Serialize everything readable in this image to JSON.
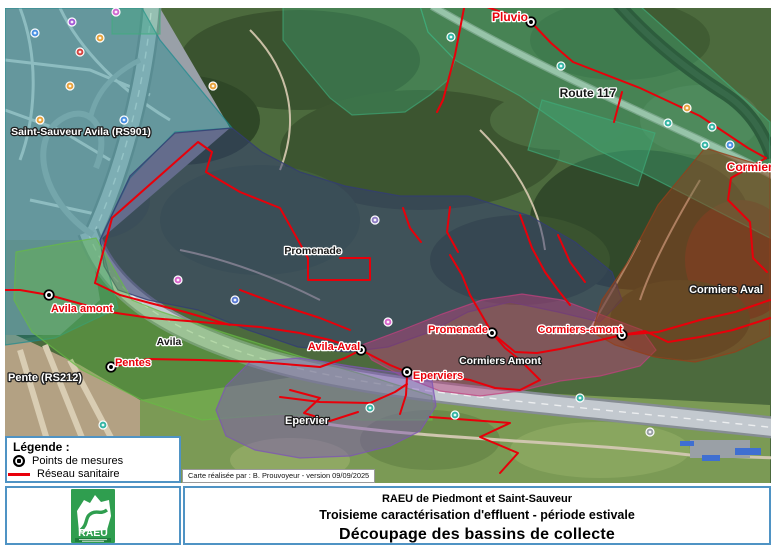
{
  "colors": {
    "network": "#e8000a",
    "box_border": "#4f93c4",
    "logo_green": "#2f9e4f"
  },
  "legend": {
    "title": "Légende :",
    "items": [
      {
        "icon": "measure-point-icon",
        "label": "Points de mesures"
      },
      {
        "icon": "sanitary-line-icon",
        "label": "Réseau sanitaire"
      }
    ]
  },
  "credit": "Carte réalisée par : B. Prouvoyeur - version 09/09/2025",
  "title_block": {
    "org": "RAEU de Piedmont et Saint-Sauveur",
    "subtitle": "Troisieme caractérisation d'effluent - période estivale",
    "title": "Découpage des bassins de collecte"
  },
  "logo": {
    "text": "RAEU"
  },
  "map": {
    "labels": [
      {
        "text": "Pluvio",
        "x": 510,
        "y": 17,
        "style": "red",
        "size": 12
      },
      {
        "text": "Route 117",
        "x": 588,
        "y": 93,
        "style": "black",
        "size": 12
      },
      {
        "text": "Cormiers",
        "x": 753,
        "y": 167,
        "style": "red",
        "size": 12
      },
      {
        "text": "Saint-Sauveur Avila (RS901)",
        "x": 81,
        "y": 131,
        "style": "white",
        "size": 10.5
      },
      {
        "text": "Promenade",
        "x": 313,
        "y": 250,
        "style": "black",
        "size": 10.5
      },
      {
        "text": "Cormiers Aval",
        "x": 726,
        "y": 289,
        "style": "white",
        "size": 11
      },
      {
        "text": "Avila amont",
        "x": 82,
        "y": 308,
        "style": "red",
        "size": 11
      },
      {
        "text": "Promenade",
        "x": 458,
        "y": 329,
        "style": "red",
        "size": 11
      },
      {
        "text": "Cormiers-amont",
        "x": 580,
        "y": 329,
        "style": "red",
        "size": 11
      },
      {
        "text": "Avila",
        "x": 169,
        "y": 341,
        "style": "black",
        "size": 10.5
      },
      {
        "text": "Avila-Aval",
        "x": 334,
        "y": 346,
        "style": "red",
        "size": 11
      },
      {
        "text": "Cormiers Amont",
        "x": 500,
        "y": 360,
        "style": "white",
        "size": 10.5
      },
      {
        "text": "Pentes",
        "x": 133,
        "y": 362,
        "style": "red",
        "size": 11
      },
      {
        "text": "Eperviers",
        "x": 438,
        "y": 375,
        "style": "red",
        "size": 11
      },
      {
        "text": "Pente (RS212)",
        "x": 45,
        "y": 377,
        "style": "white",
        "size": 11
      },
      {
        "text": "Epervier",
        "x": 307,
        "y": 420,
        "style": "white",
        "size": 11
      }
    ],
    "measure_points": [
      {
        "x": 531,
        "y": 22
      },
      {
        "x": 49,
        "y": 295
      },
      {
        "x": 111,
        "y": 367
      },
      {
        "x": 361,
        "y": 350
      },
      {
        "x": 407,
        "y": 372
      },
      {
        "x": 492,
        "y": 333
      },
      {
        "x": 622,
        "y": 335
      }
    ],
    "basins": [
      {
        "name": "Saint-Sauveur Avila (RS901)",
        "color": "#1d8a8f",
        "opacity": 0.42,
        "points": "5,8 142,8 160,40 232,128 175,132 130,178 100,240 118,308 55,338 5,345"
      },
      {
        "name": "Pluvio",
        "color": "#3fae7c",
        "opacity": 0.38,
        "points": "420,6 640,6 703,62 770,122 770,238 688,196 598,150 520,96 455,60 428,32"
      },
      {
        "name": "",
        "color": "#3fae7c",
        "opacity": 0.34,
        "points": "283,6 420,6 428,32 455,60 448,80 430,95 405,112 352,115 330,98 300,62 283,40"
      },
      {
        "name": "",
        "color": "#3fae7c",
        "opacity": 0.34,
        "points": "112,6 160,6 160,34 112,34"
      },
      {
        "name": "",
        "color": "#3fae7c",
        "opacity": 0.34,
        "points": "542,100 655,133 638,186 528,150"
      },
      {
        "name": "Promenade",
        "color": "#333d73",
        "opacity": 0.52,
        "points": "100,240 130,176 175,133 232,128 262,152 300,172 345,186 400,196 468,196 530,216 575,242 612,272 622,300 600,322 558,312 510,302 468,312 430,332 388,347 348,352 298,347 248,330 198,310 148,300 118,290 104,266"
      },
      {
        "name": "Avila",
        "color": "#66bb44",
        "opacity": 0.42,
        "points": "16,252 60,244 96,238 132,300 162,312 222,332 302,357 372,377 432,396 432,420 362,420 282,414 202,420 142,400 82,370 32,332 14,300"
      },
      {
        "name": "Cormiers Amont",
        "color": "#c2407e",
        "opacity": 0.45,
        "points": "362,345 402,330 442,314 482,300 522,294 562,300 602,315 642,330 656,350 640,366 600,376 560,381 520,391 480,396 440,391 402,376 372,360"
      },
      {
        "name": "Cormiers Aval",
        "color": "#93401b",
        "opacity": 0.5,
        "points": "705,148 770,168 770,336 735,352 695,362 655,357 615,345 592,332 602,300 628,262 658,205"
      },
      {
        "name": "Epervier",
        "color": "#7e55b5",
        "opacity": 0.48,
        "points": "250,362 300,358 350,366 400,373 432,381 436,406 420,431 390,446 350,456 300,458 255,450 226,436 216,410 226,386"
      }
    ],
    "network": [
      "465,3 455,55 443,100 437,112",
      "478,4 531,22",
      "531,22 551,43 573,62 640,88 700,116 748,148 766,158",
      "622,92 614,122",
      "766,158 731,178 728,200 750,222 753,258 767,272",
      "770,300 735,312 700,320 658,332 622,335",
      "622,335 596,341 560,349 537,353 515,352 492,333",
      "622,335 645,331 668,342 700,337 733,330 770,318",
      "492,333 480,312 470,295 462,275 450,255",
      "492,333 505,348 520,360 540,380 520,390 495,388 470,380 445,376 420,373 407,372",
      "407,372 390,365 361,350",
      "361,350 330,340 300,333 260,327 200,322 150,318 110,312 49,295",
      "49,295 20,290 0,290",
      "111,367 148,359 200,360 260,362 320,367 345,358 361,350",
      "407,377 406,395 400,414",
      "280,397 320,402 370,403 395,392 407,384",
      "290,390 320,398 304,413 330,421 358,412",
      "430,417 510,423 480,437 518,453 500,473",
      "95,283 112,218 198,142 212,152 206,172",
      "206,172 240,192 280,208 308,258 308,280 370,280 370,258 340,258",
      "403,208 410,228 421,242",
      "450,207 447,232 458,252",
      "520,215 532,248 545,272 558,290 570,305",
      "558,235 570,262 585,282",
      "95,283 120,295 150,303 185,312 230,325",
      "240,290 280,305 320,318 350,330"
    ],
    "poi_icons": [
      {
        "x": 116,
        "y": 12,
        "c": "#cf6ad1"
      },
      {
        "x": 72,
        "y": 22,
        "c": "#a45bd6"
      },
      {
        "x": 35,
        "y": 33,
        "c": "#4a90e2"
      },
      {
        "x": 100,
        "y": 38,
        "c": "#e8a33d"
      },
      {
        "x": 80,
        "y": 52,
        "c": "#d64541"
      },
      {
        "x": 70,
        "y": 86,
        "c": "#e8a33d"
      },
      {
        "x": 40,
        "y": 120,
        "c": "#e8a33d"
      },
      {
        "x": 213,
        "y": 86,
        "c": "#e8a33d"
      },
      {
        "x": 124,
        "y": 120,
        "c": "#4a90e2"
      },
      {
        "x": 375,
        "y": 220,
        "c": "#8e7cc3"
      },
      {
        "x": 178,
        "y": 280,
        "c": "#d966cc"
      },
      {
        "x": 235,
        "y": 300,
        "c": "#5b7bd5"
      },
      {
        "x": 388,
        "y": 322,
        "c": "#d966cc"
      },
      {
        "x": 451,
        "y": 37,
        "c": "#35b5a5"
      },
      {
        "x": 561,
        "y": 66,
        "c": "#35b5a5"
      },
      {
        "x": 668,
        "y": 123,
        "c": "#35b5a5"
      },
      {
        "x": 712,
        "y": 127,
        "c": "#35b5a5"
      },
      {
        "x": 705,
        "y": 145,
        "c": "#35b5a5"
      },
      {
        "x": 730,
        "y": 145,
        "c": "#4a90e2"
      },
      {
        "x": 687,
        "y": 108,
        "c": "#e8a33d"
      },
      {
        "x": 370,
        "y": 408,
        "c": "#35b5a5"
      },
      {
        "x": 455,
        "y": 415,
        "c": "#35b5a5"
      },
      {
        "x": 580,
        "y": 398,
        "c": "#35b5a5"
      },
      {
        "x": 103,
        "y": 425,
        "c": "#35b5a5"
      },
      {
        "x": 650,
        "y": 432,
        "c": "#9aa0a6"
      }
    ]
  }
}
